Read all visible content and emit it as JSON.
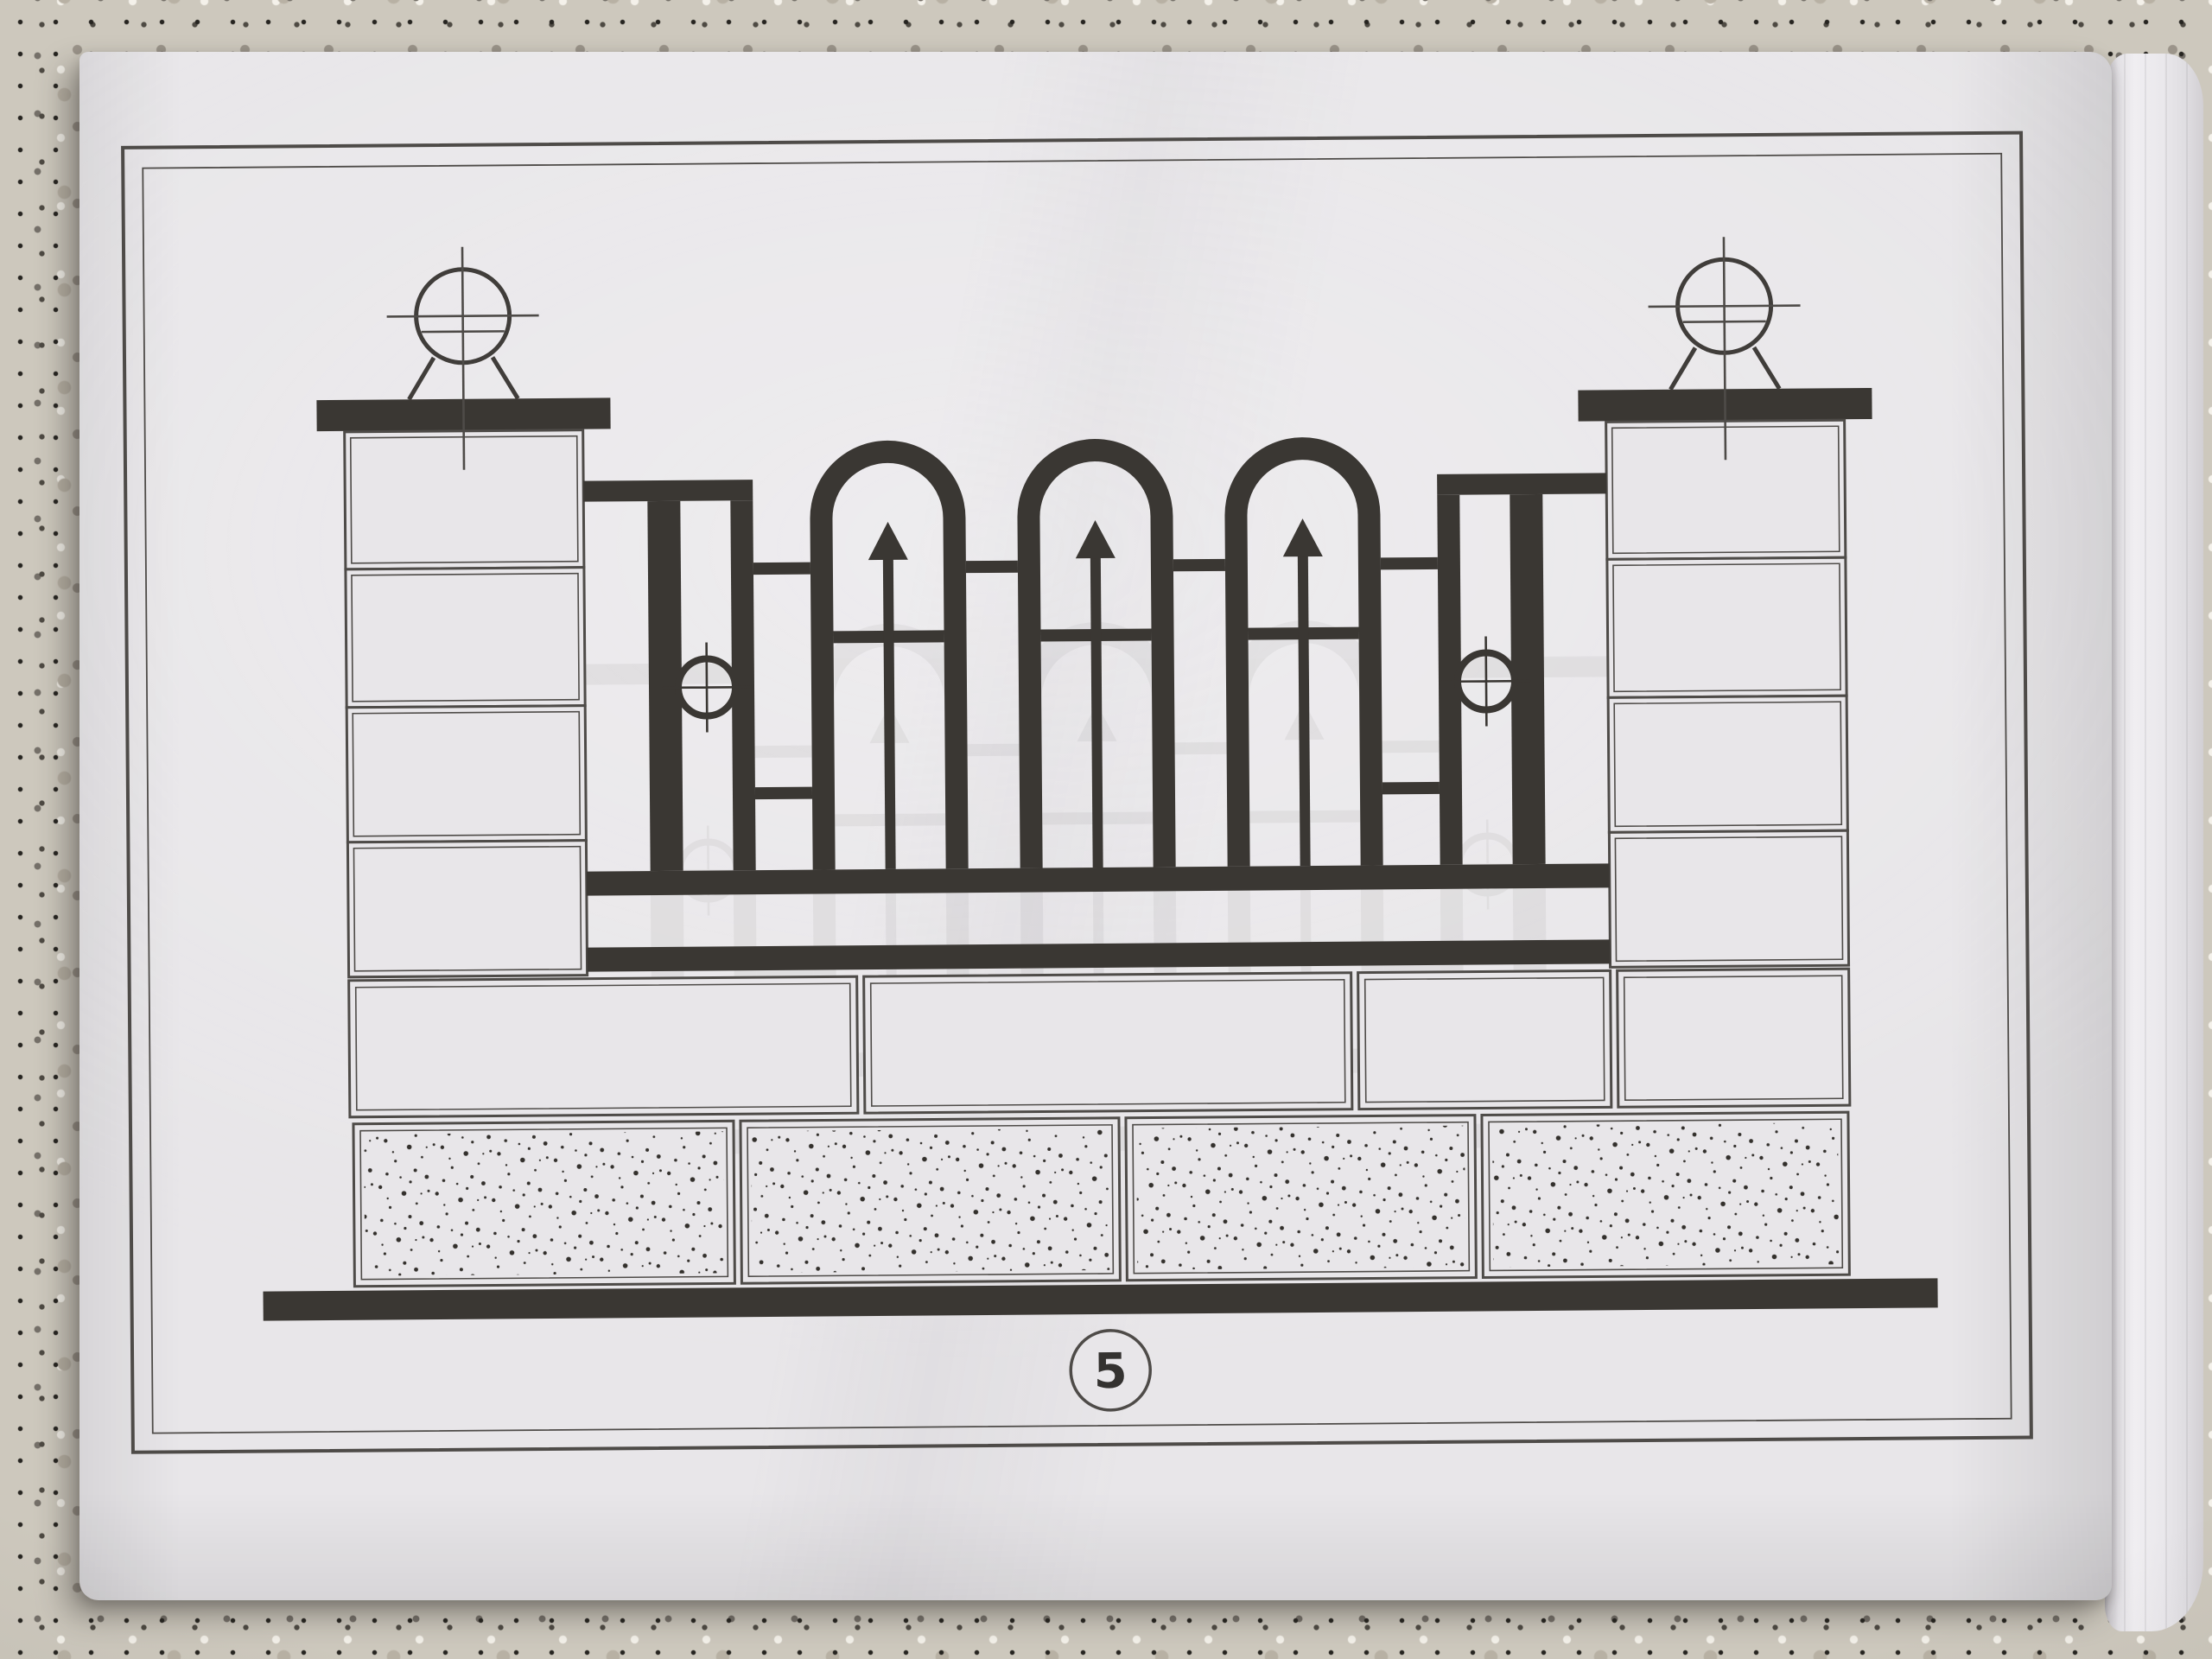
{
  "page": {
    "number": "5"
  },
  "figure": {
    "pillars": 2,
    "sphere_finials": 2,
    "arched_panels": 3,
    "spear_pickets": 3,
    "ring_ornaments": 2,
    "masonry_plain_blocks": 4,
    "masonry_stippled_blocks": 4,
    "bottom_rails": 2
  },
  "colors": {
    "paper": "#e8e6e9",
    "paper_deep": "#d9d7db",
    "ink": "#3a3733",
    "line": "#4e4b48",
    "granite": "#cdc8bd",
    "fore_edge": "#edebee",
    "digit": "#343230"
  }
}
